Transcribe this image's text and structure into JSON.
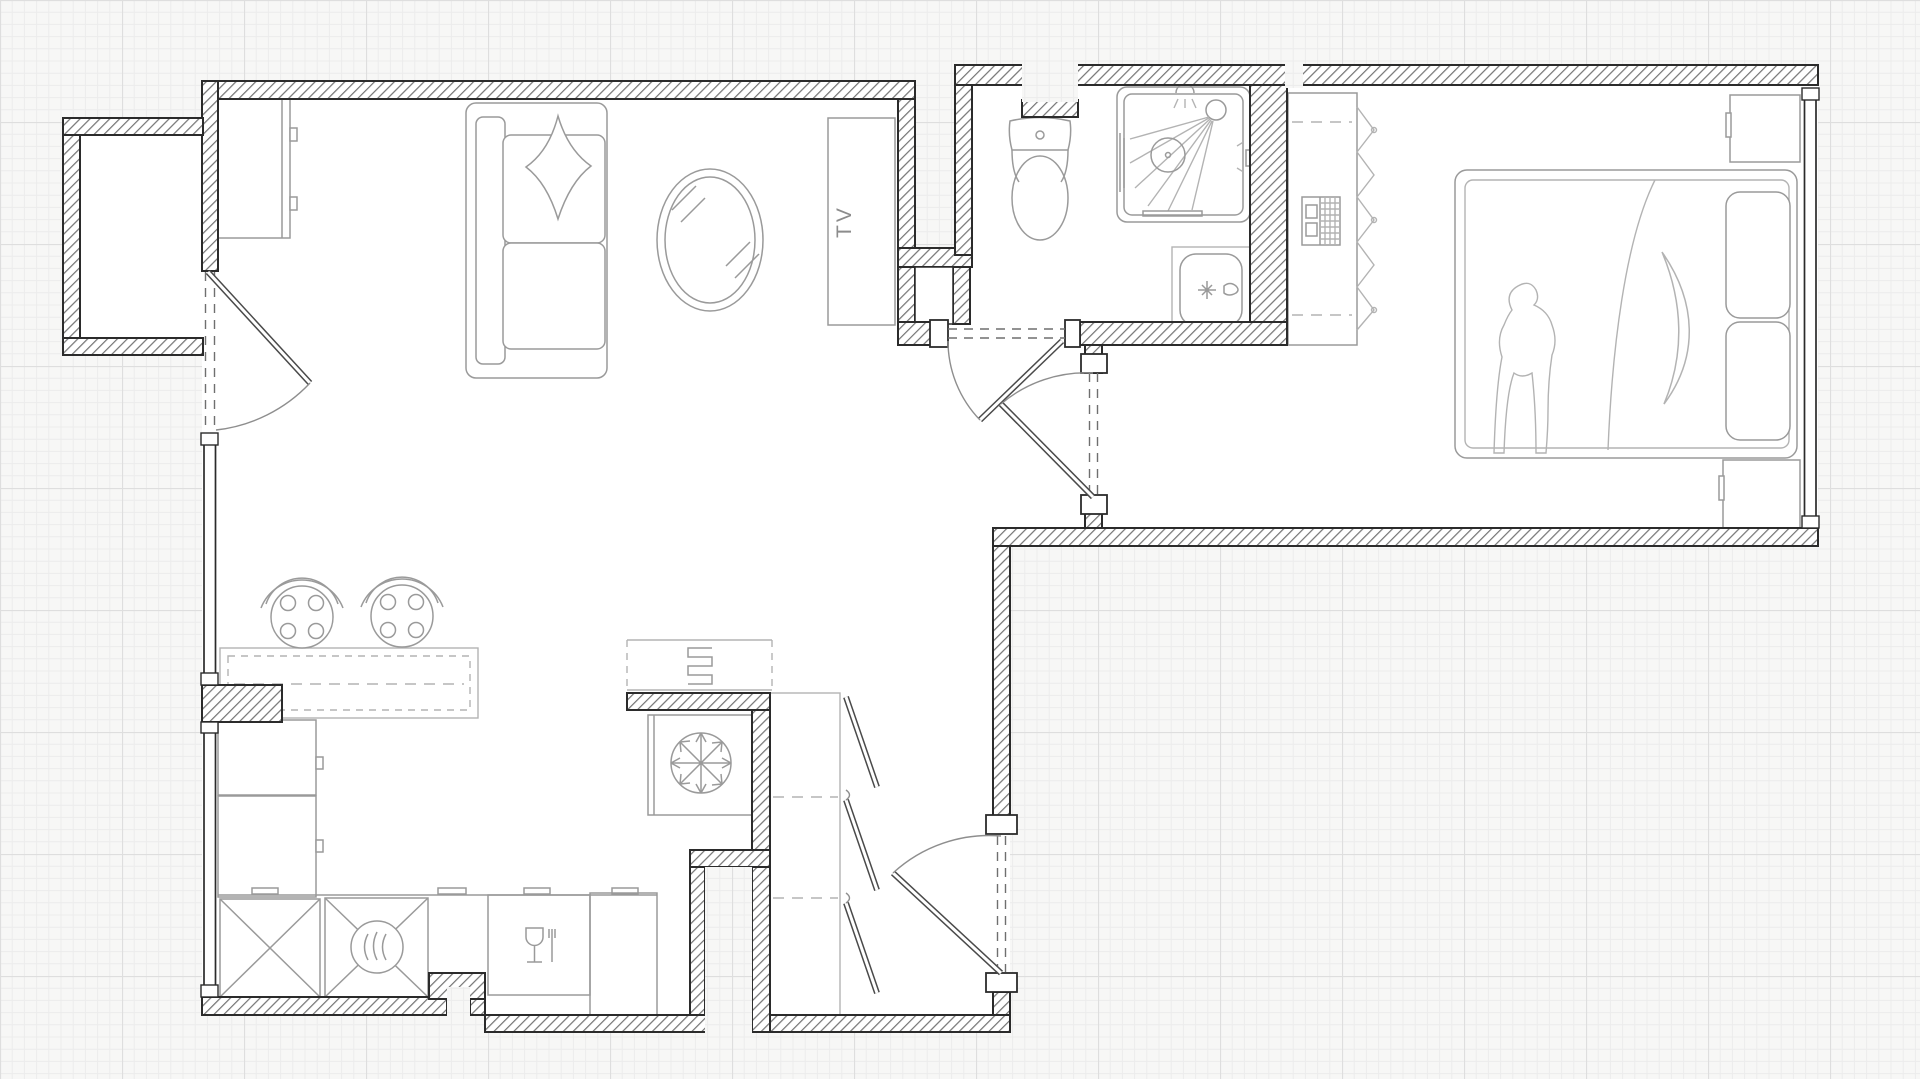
{
  "title": "apartment-floor-plan",
  "labels": {
    "tv": "TV"
  },
  "colors": {
    "background": "#f7f7f6",
    "grid_fine": "#ececec",
    "grid_major": "#dedede",
    "wall_outline": "#2b2b2b",
    "wall_hatch": "#757575",
    "furniture_stroke": "#9a9a9a",
    "furniture_light": "#b3b3b3",
    "label_text": "#8c8c8c",
    "floor": "#ffffff"
  },
  "rooms": [
    {
      "name": "balcony"
    },
    {
      "name": "living-room"
    },
    {
      "name": "kitchen"
    },
    {
      "name": "hallway"
    },
    {
      "name": "bathroom"
    },
    {
      "name": "bedroom"
    }
  ],
  "furniture": [
    {
      "room": "living-room",
      "item": "wardrobe-cabinet"
    },
    {
      "room": "living-room",
      "item": "sofa-with-pillow"
    },
    {
      "room": "living-room",
      "item": "oval-coffee-table"
    },
    {
      "room": "living-room",
      "item": "tv-board",
      "label": "TV"
    },
    {
      "room": "kitchen",
      "item": "island-table"
    },
    {
      "room": "kitchen",
      "item": "stool",
      "count": 2
    },
    {
      "room": "kitchen",
      "item": "tall-cabinets"
    },
    {
      "room": "kitchen",
      "item": "base-cabinet-x"
    },
    {
      "room": "kitchen",
      "item": "oven"
    },
    {
      "room": "kitchen",
      "item": "dishwasher"
    },
    {
      "room": "kitchen",
      "item": "fridge"
    },
    {
      "room": "kitchen",
      "item": "radiator"
    },
    {
      "room": "hallway",
      "item": "louvered-closet"
    },
    {
      "room": "hallway",
      "item": "entry-door"
    },
    {
      "room": "bathroom",
      "item": "toilet"
    },
    {
      "room": "bathroom",
      "item": "shower-cabin"
    },
    {
      "room": "bathroom",
      "item": "sink"
    },
    {
      "room": "bedroom",
      "item": "open-wardrobe-with-hangers"
    },
    {
      "room": "bedroom",
      "item": "ac-panel"
    },
    {
      "room": "bedroom",
      "item": "double-bed"
    },
    {
      "room": "bedroom",
      "item": "nightstand",
      "count": 2
    }
  ],
  "icons": [
    "snowflake-icon",
    "oven-heat-icon",
    "dishwasher-glass-fork-icon",
    "radiator-coil-icon",
    "shower-head-icon",
    "sprinkler-icon",
    "faucet-icon"
  ]
}
